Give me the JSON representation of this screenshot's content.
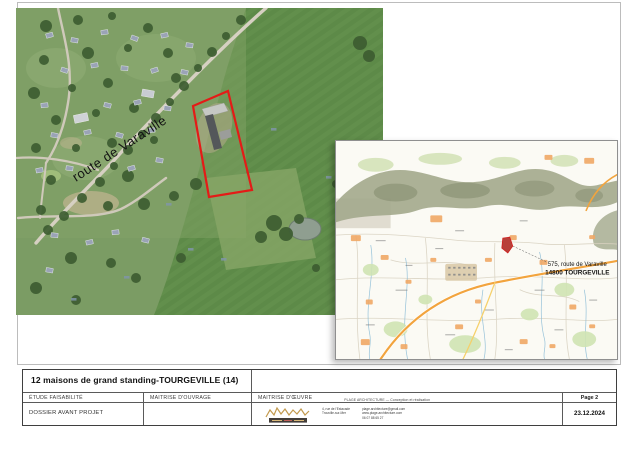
{
  "aerial": {
    "road_label": "route de Varaville"
  },
  "map_inset": {
    "address_label_line1": "575, route de Varaville",
    "address_label_line2": "14800 TOURGEVILLE"
  },
  "title_block": {
    "project_title": "12 maisons de grand standing-TOURGEVILLE (14)",
    "col1_header": "ÉTUDE FAISABILITÉ",
    "col2_header": "MAITRISE D'OUVRAGE",
    "col3_header": "MAITRISE D'ŒUVRE",
    "page_label": "Page 2",
    "phase": "DOSSIER AVANT PROJET",
    "date": "23.12.2024",
    "architect": {
      "firm_line": "PLAGE ARCHITECTURE — Conception et réalisation",
      "address_line1": "4, rue de l'Estacade",
      "address_line2": "Trouville-sur-Mer",
      "contact_line1": "plage.architecture@gmail.com",
      "contact_line2": "www.plage-architecture.com",
      "contact_line3": "06 07 88 65 27"
    }
  },
  "colors": {
    "plot_outline": "#e41b17",
    "map_parcel_fill": "#b8403a",
    "logo_gold": "#c39a4e",
    "main_road_orange": "#f2a43e"
  }
}
